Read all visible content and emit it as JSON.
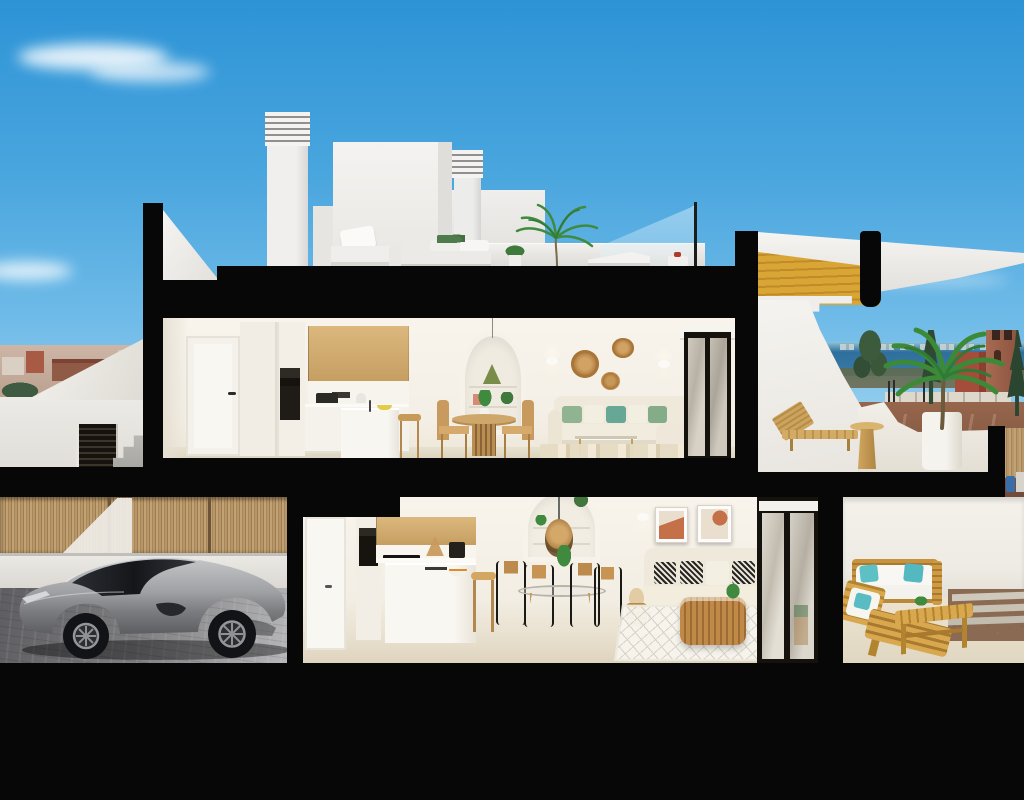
{
  "scene": {
    "title": "Cutaway cross-section 3D render of a modern two-storey coastal villa with rooftop terrace",
    "style": "photorealistic architectural visualization, no text or UI elements",
    "palette": {
      "sky_top": "#2d93d6",
      "sky_low": "#a6d7f0",
      "structure_black": "#070707",
      "wall_white": "#f2efe9",
      "wall_shade": "#e4dfd4",
      "floor_beige": "#e3dac6",
      "wood_cabinet": "#dcb87e",
      "stair_gold": "#d9a636",
      "bamboo_fence": "#b3905f",
      "sea_blue": "#2f6f9d",
      "dirt_red": "#96664c",
      "brick_tower": "#9a604a",
      "leaf_green": "#3f8a3e",
      "teal_pillow": "#5cc0c4",
      "sage_pillow": "#8fb48f",
      "car_silver": "#9fa1a4",
      "driveway_grey": "#86878a",
      "gravel_brown": "#8a6a52",
      "rattan": "#c89a5e"
    },
    "sky": {
      "clouds": [
        "large wispy cloud top-left",
        "small cloud mid-left",
        "thin wisp right of stairs"
      ]
    },
    "background": {
      "left": [
        "hazy town skyline with red and white houses",
        "dark green trees"
      ],
      "right": [
        "sea horizon with distant city silhouette",
        "brick watchtower with pitched roof",
        "red building",
        "conifer trees",
        "white fence with street lamps",
        "red-brown dirt ground",
        "blue barrel",
        "bamboo fence sliver"
      ]
    },
    "rooftop": {
      "objects": [
        "louvered chimney tall",
        "louvered chimney short",
        "white penthouse volume",
        "white stair parapet triangle",
        "low roof parapet",
        "glass balustrade with post",
        "white outdoor armchair",
        "white outdoor sofa with planter",
        "potted plant",
        "small palm tree",
        "white sun lounger",
        "tray with red teapot"
      ]
    },
    "right_section": {
      "objects": [
        "golden timber staircase in section",
        "white stepped stringer",
        "black rounded column",
        "white curved sail volume"
      ]
    },
    "upper_floor": {
      "objects": [
        "white interior door with black handle",
        "tall cabinet with built-in black oven",
        "oak upper cabinets",
        "white counter with pots and kettle",
        "white kitchen island with faucet and yellow bowl",
        "wooden stool",
        "arched shelf niche with green lamp and plants",
        "round wooden dining table with plant centerpiece",
        "rattan dining chairs",
        "three rattan wall discs",
        "two white wall sconces",
        "cream corner sofa with sage and teal cushions",
        "glass and gold coffee table",
        "striped beige rug",
        "black framed sliding glass door with roller blind"
      ]
    },
    "upper_terrace": {
      "objects": [
        "white curved parapet wall",
        "wooden sun lounger",
        "round wooden side table",
        "white planter pot with large palm",
        "black floor slab edge"
      ]
    },
    "ground_floor": {
      "exterior_left": [
        "bamboo reed fence",
        "white boundary wall",
        "grey paved driveway",
        "silver sports coupe parked",
        "dark louvered entrance gate",
        "exterior concrete stairs"
      ],
      "interior": [
        "white interior door",
        "tall unit with black oven",
        "oak upper cabinets",
        "black cooktop",
        "coffee machine",
        "rattan counter lamp",
        "white island with sink and fruit bowl",
        "wooden stool",
        "glass dining table with four wood-and-black chairs",
        "arched niche with rattan pendant lamp and plants",
        "two abstract terracotta artworks",
        "white wall sconce",
        "cream sofa with black-and-white patterned cushions",
        "dried pampas basket",
        "white diamond-pattern rug",
        "round rattan coffee table",
        "black framed sliding glass doors"
      ],
      "terrace_right": [
        "white parapet wall",
        "teak outdoor sofa with white cushions and teal pillows",
        "teak chaise",
        "teak slat bench table with plant",
        "gravel strip with concrete pavers"
      ]
    },
    "structure": {
      "cut_slabs": "thick matte black cut lines outline roof, floor slabs, columns and foundation"
    }
  }
}
